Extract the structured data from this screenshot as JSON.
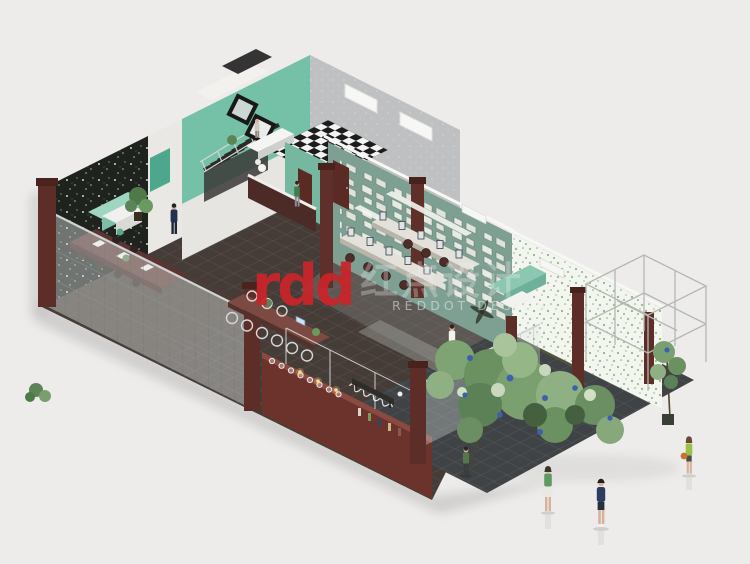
{
  "watermark": {
    "logo_text": "rdd",
    "logo_color": "#c9252a",
    "cn_text": "红点设计",
    "en_text": "REDDOT DESIGN",
    "text_color": "#f0f2f2"
  },
  "palette": {
    "background": "#edecea",
    "pavement": "#3f4345",
    "interior_floor": "#453c38",
    "wall_floral_dark": "#1f231e",
    "wall_wood": "#a87c46",
    "wall_teal": "#74c1a7",
    "wall_sage_frames": "#7ea092",
    "wall_gray_tile": "#bfc0c2",
    "wall_ivy_white": "#f3f5ef",
    "maroon": "#5d2d27",
    "bar_maroon": "#6b332c",
    "glass_tint": "#dfe7e5",
    "foliage_green": "#7ba06f",
    "flower_blue": "#3e5fae",
    "checker_dark": "#1c1c1c",
    "checker_light": "#f2f2f2"
  },
  "scene": {
    "type": "isometric cutaway interior rendering",
    "rooms": [
      "restroom with checkerboard floor and black-framed mirrors",
      "staircase hall",
      "meeting room with dark floral wallpaper and wood-slat partition",
      "open office with desk rows and suspended lights",
      "gallery wall covered in small picture frames",
      "bar counter with hanging stemware and cursive signage",
      "courtyard with glazed pergola frame and ivy end wall"
    ],
    "figures": [
      "man in dark suit in meeting room",
      "person in green shirt at pantry",
      "person on stair landing",
      "walker in white shirt in courtyard",
      "person in green vest on pavement",
      "woman in green top and white skirt",
      "man in navy jacket and shorts",
      "woman in lime top with orange bag"
    ],
    "plants": [
      "large entry tree with blue blossoms",
      "potted plant at right edge",
      "shrub at left pillar",
      "ivy-covered end wall"
    ]
  }
}
